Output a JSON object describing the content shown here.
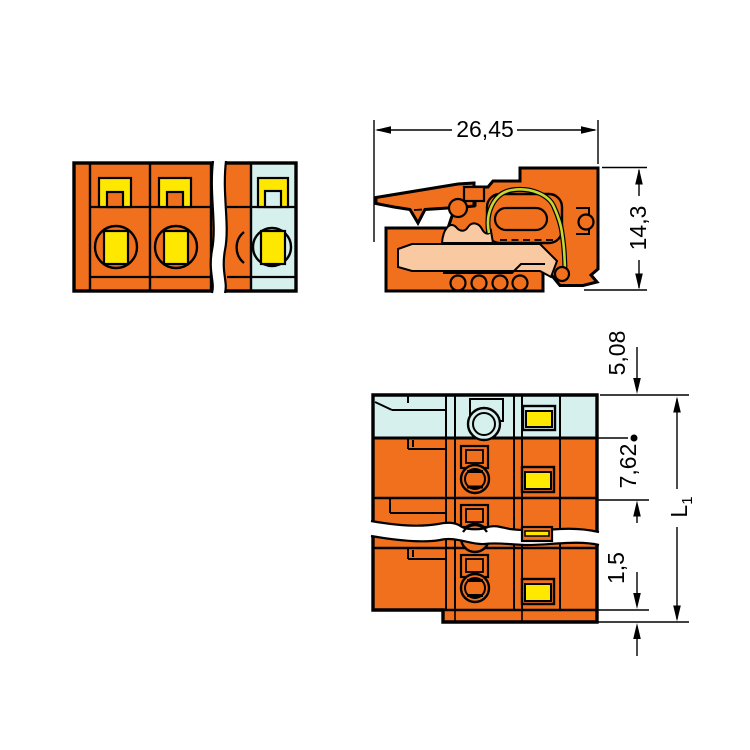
{
  "dimensions": {
    "width": {
      "label": "26,45"
    },
    "height": {
      "label": "14,3"
    },
    "end_spacing": {
      "label": "5,08"
    },
    "pitch": {
      "label": "7,62"
    },
    "flange": {
      "label": "1,5"
    },
    "length": {
      "label": "L",
      "subscript": "1"
    }
  },
  "colors": {
    "body_orange": "#F1701E",
    "last_pole_cyan": "#D6F0EE",
    "detail_yellow": "#FFE800",
    "section_peach": "#F9C9A1",
    "spring_green": "#C5D831",
    "line_black": "#000000"
  }
}
